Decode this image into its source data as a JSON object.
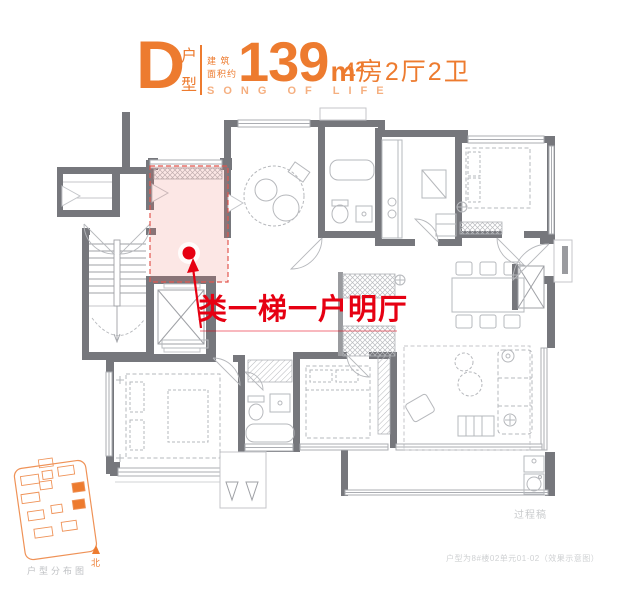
{
  "header": {
    "type_letter": "D",
    "type_label": "户型",
    "area_label_line1": "建 筑",
    "area_label_line2": "面积约",
    "area_value": "139",
    "area_unit": "m²",
    "layout_text": "4房2厅2卫",
    "slogan": "SONG OF LIFE"
  },
  "annotation": {
    "text": "类一梯一户明厅"
  },
  "minimap": {
    "caption": "户型分布图",
    "north_label": "北"
  },
  "footnotes": {
    "watermark": "过程稿",
    "disclaimer": "户型为8#楼02单元01·02（效果示意图）"
  },
  "colors": {
    "accent_orange": "#ED7B2F",
    "accent_orange_light": "#F5AF80",
    "minimap_orange": "#EF9257",
    "highlight_red": "#E60012",
    "highlight_pink_fill": "rgba(236,106,95,0.16)",
    "highlight_pink_border": "#E2574F",
    "wall_gray": "#76777C",
    "furniture_gray": "#B6B8BC",
    "caption_gray": "#C6C8CA"
  }
}
